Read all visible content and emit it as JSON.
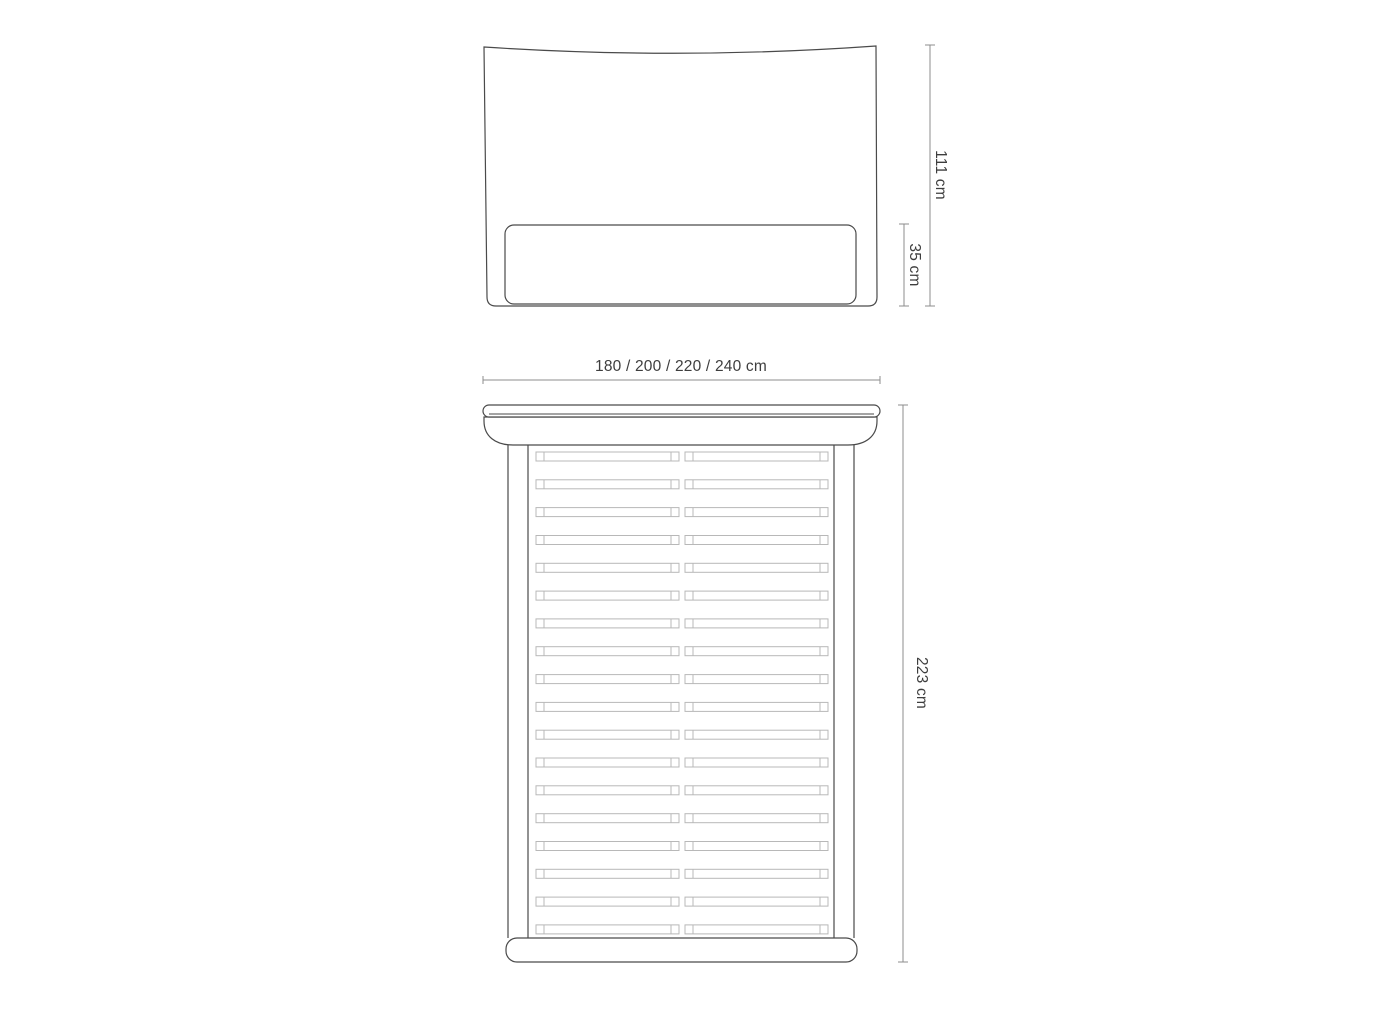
{
  "diagram_title": "bed-dimension-drawing",
  "views": {
    "headboard_front": {
      "height_label": "111 cm",
      "panel_height_label": "35 cm"
    },
    "bed_top": {
      "width_label": "180 / 200 / 220 / 240 cm",
      "length_label": "223 cm",
      "slat_count": 18,
      "slat_halves_per_row": 2
    }
  },
  "colors": {
    "outline": "#4a4a4a",
    "slat": "#b8b8b8",
    "dimension": "#8c8c8c",
    "text": "#3e3e3e",
    "background": "#ffffff"
  }
}
